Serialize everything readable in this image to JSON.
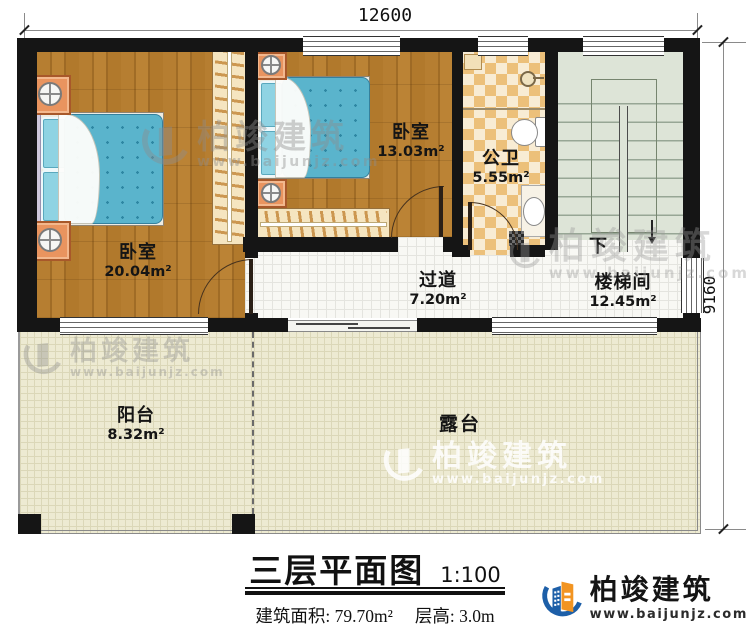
{
  "dimensions": {
    "width": "12600",
    "height": "9160"
  },
  "rooms": {
    "bedroom_left": {
      "label": "卧室",
      "area": "20.04m²"
    },
    "bedroom_top": {
      "label": "卧室",
      "area": "13.03m²"
    },
    "bathroom": {
      "label": "公卫",
      "area": "5.55m²"
    },
    "corridor": {
      "label": "过道",
      "area": "7.20m²"
    },
    "stairwell": {
      "label": "楼梯间",
      "area": "12.45m²"
    },
    "balcony": {
      "label": "阳台",
      "area": "8.32m²"
    },
    "terrace": {
      "label": "露台"
    }
  },
  "stairs": {
    "direction_label": "下"
  },
  "titleblock": {
    "title": "三层平面图",
    "scale": "1:100",
    "area_line": "建筑面积: 79.70m²",
    "height_line": "层高: 3.0m"
  },
  "brand": {
    "name": "柏竣建筑",
    "website": "www.baijunjz.com"
  },
  "colors": {
    "wall": "#151515",
    "wood": "#b1792c",
    "mattress": "#5ab4cc",
    "checker": "#ecc07a",
    "stair_floor": "#dde4d7",
    "tile": "#f8f8f4",
    "outdoor": "#edead2",
    "brand_blue": "#1d5fa8",
    "brand_orange": "#f29421"
  }
}
